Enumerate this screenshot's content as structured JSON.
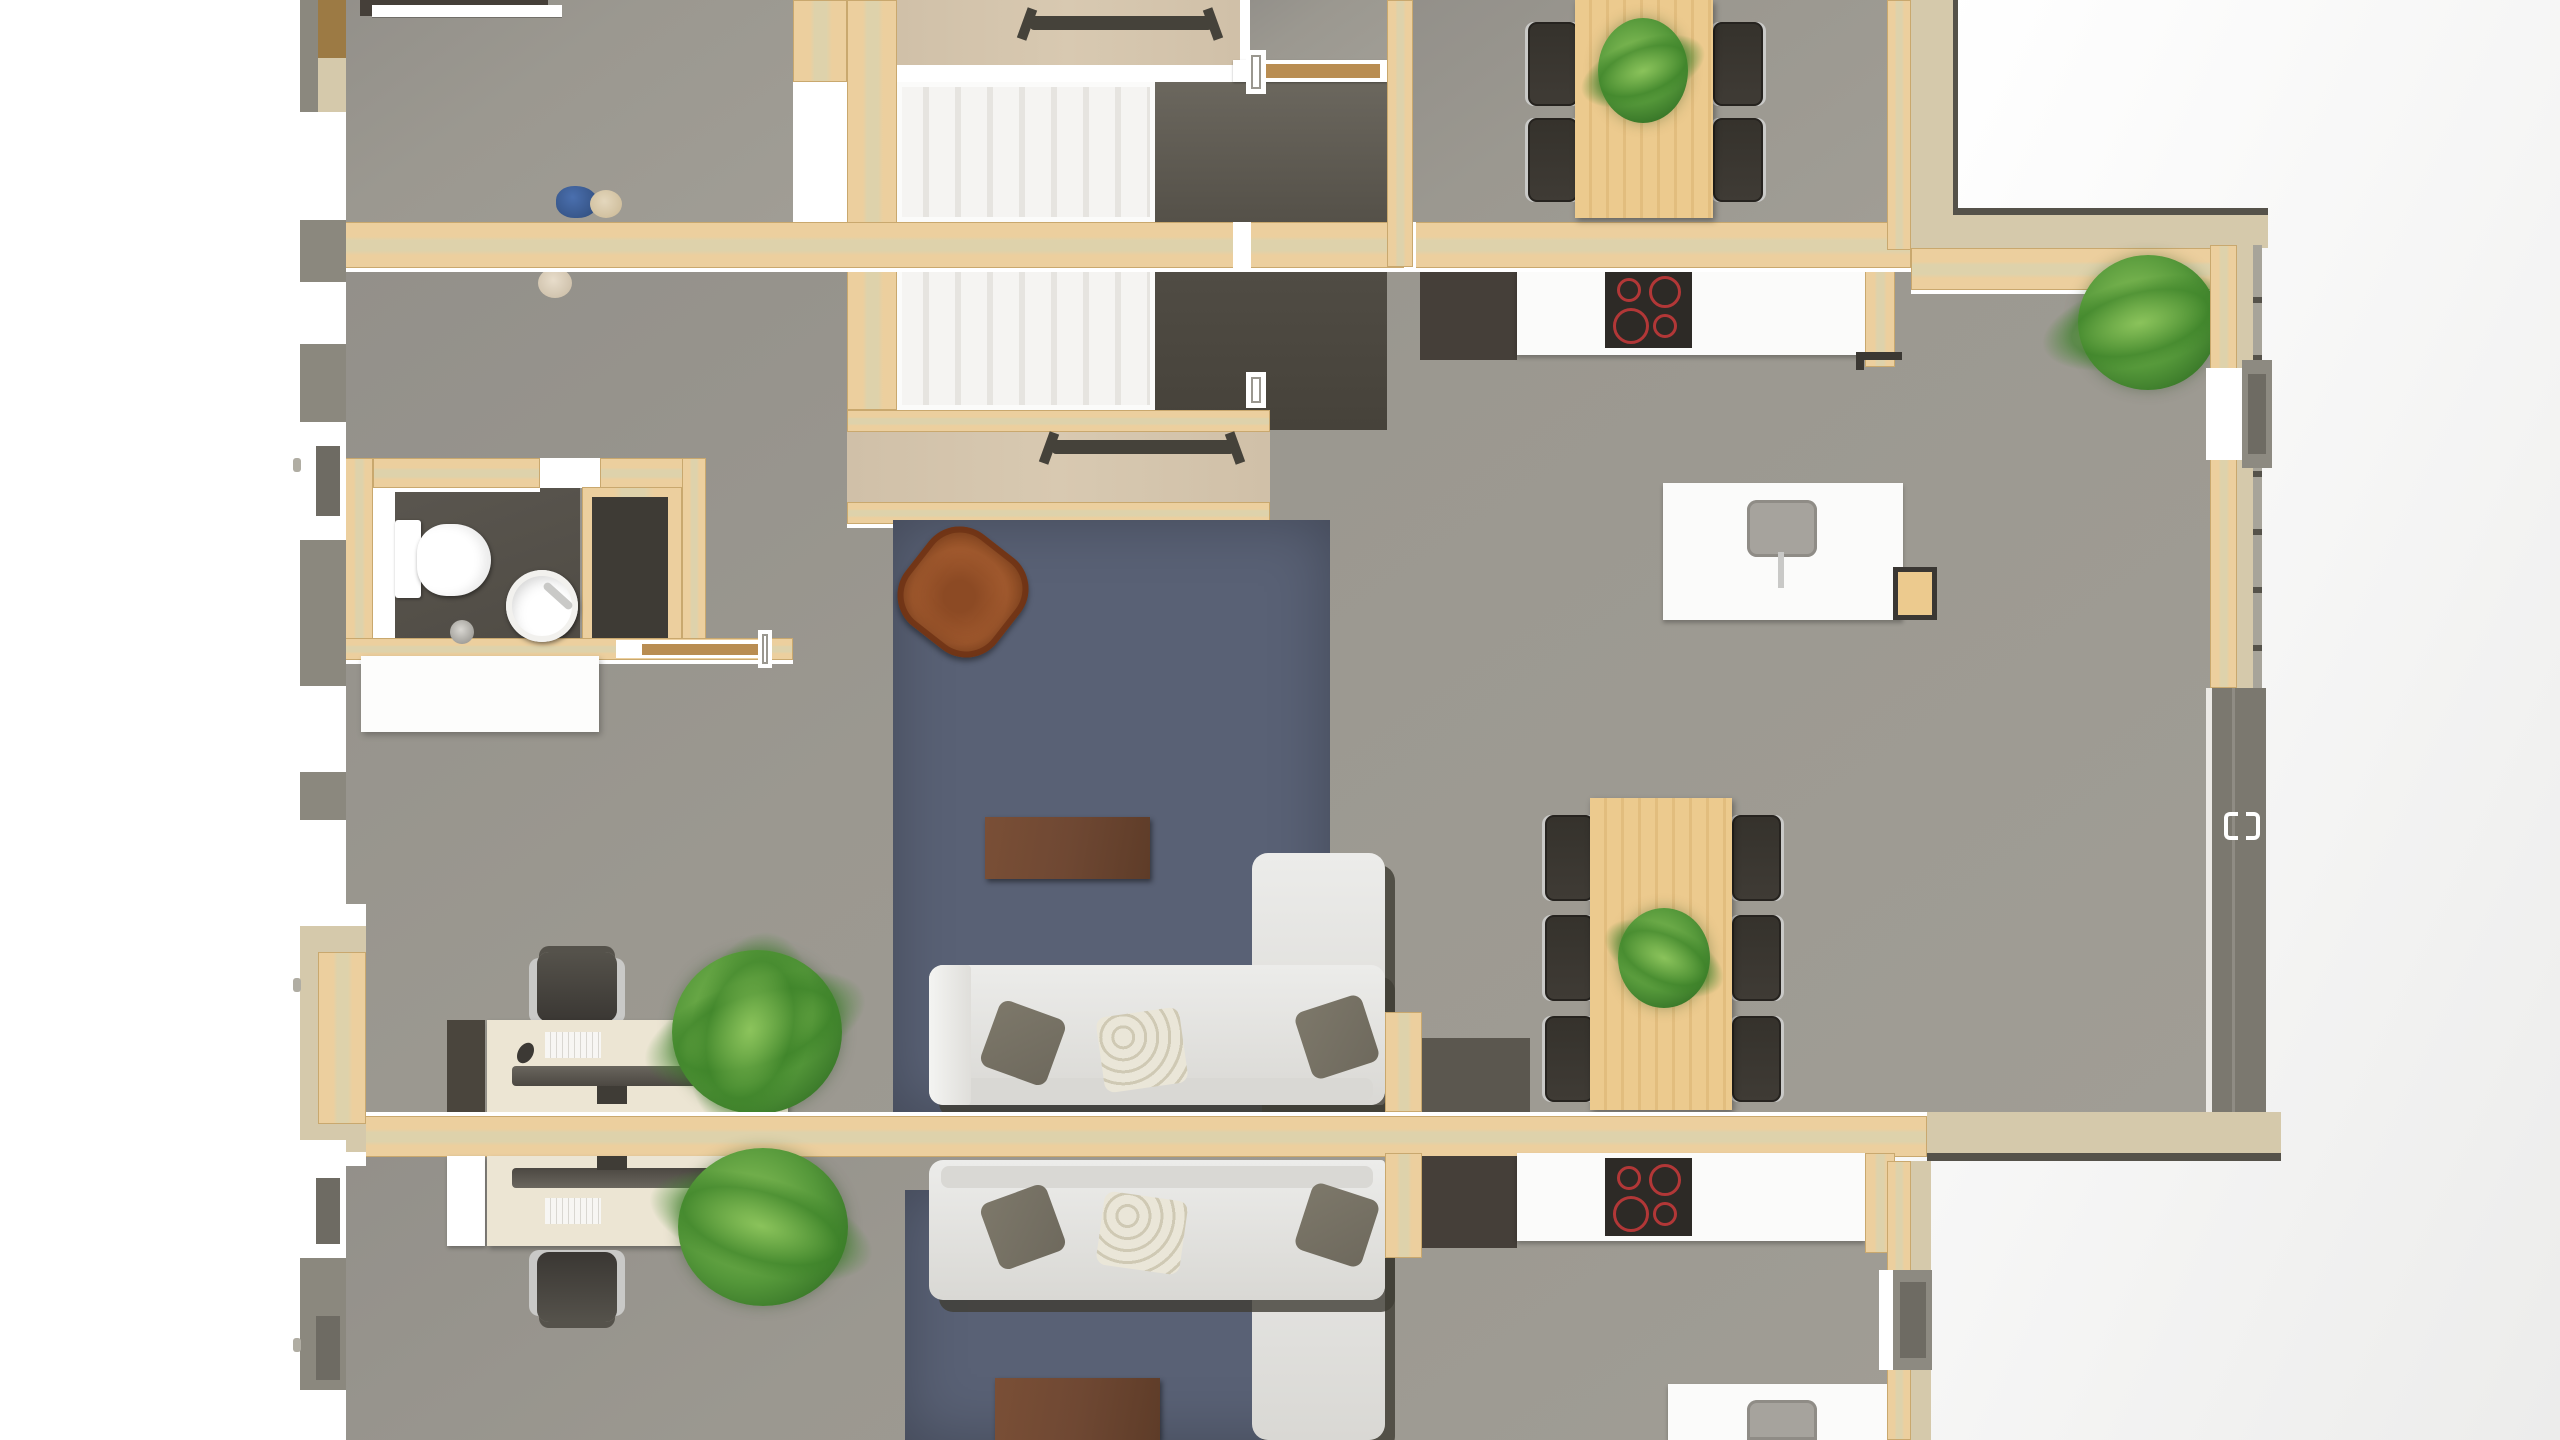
{
  "meta": {
    "kind": "3d-floorplan-top-down-render",
    "units": 2,
    "note": "photorealistic architectural plan render, no on-screen text"
  },
  "colors": {
    "floor": "#9b9890",
    "floor2": "#a09d95",
    "wood": "#eccf9e",
    "wood_stripe": "#ded2ab",
    "wood_edge": "#c9a86e",
    "landing": "#d0c0a8",
    "exterior_gray": "#8b887e",
    "exterior_beige": "#d5c9ab",
    "dark_floor": "#4f4b44",
    "closet_dark": "#3e3b35",
    "shaft_dark": "#524e46",
    "shaft_light": "#6b675e",
    "rug": "#596175",
    "table_brown": "#6f4833",
    "armchair": "#a35b2f",
    "armchair_dark": "#6e3315",
    "sofa": "#ececea",
    "sofa_shade": "#d9d8d4",
    "sofa_shadow": "#403d34",
    "pillow_dark": "#6e695d",
    "pillow_floral": "#eae6d8",
    "dining_wood": "#ecca8e",
    "chair_dark": "#3f3b35",
    "chair_edge": "#26231f",
    "metal": "#c9c9c7",
    "cooktop": "#2d2a26",
    "burner": "#b23737",
    "appliance_dark": "#453f39",
    "white": "#ffffff",
    "counter": "#fbfbfa",
    "sink": "#a6a39d",
    "sink_dark": "#8f8c86",
    "desk": "#ece5d3",
    "monitor": "#4c4842",
    "office_chair": "#3a3733",
    "plant_dark": "#2e6b22",
    "plant_mid": "#55983a",
    "plant_light": "#8cc45c",
    "bench": "#45423a",
    "step_a": "#f5f4f2",
    "step_b": "#e6e4e0",
    "glass_gray": "#7b786f",
    "window_box": "#8d8a81",
    "window_inner": "#6e6b63",
    "line_dark": "#55524a",
    "outside_shade": "#ececeb",
    "shoe_blue": "#4a6fae",
    "shoe_tan": "#c9b793",
    "bed_white": "#fdfdfc"
  },
  "scene": {
    "objects": [
      "stairwell-double-flight",
      "landing-bench-top",
      "landing-bench-bottom",
      "dining-table-top-with-plant",
      "dining-chairs-top-x4",
      "dining-table-mid-with-plant",
      "dining-chairs-mid-x6",
      "kitchen-counter-upper",
      "cooktop-4-burners-upper",
      "fridge-upper",
      "kitchen-island-with-sink-upper",
      "bar-stool",
      "kitchen-counter-lower",
      "cooktop-4-burners-lower",
      "fridge-lower",
      "kitchen-island-with-sink-lower",
      "blue-rug-upper",
      "coffee-table-upper",
      "l-shaped-sofa-upper",
      "pillows-x3-upper",
      "blue-rug-lower",
      "coffee-table-lower",
      "l-shaped-sofa-lower",
      "pillows-x3-lower",
      "leather-armchair",
      "bathroom-toilet",
      "bathroom-round-sink",
      "bathroom-shower-closet",
      "bathroom-cabinet",
      "white-wardrobe-bed",
      "desk-upper-with-monitor-keyboard-mouse",
      "office-chair-upper",
      "dark-cabinet-upper",
      "desk-lower-with-monitor-keyboard-phone",
      "office-chair-lower",
      "white-cabinet-lower",
      "palm-plant-upper-office",
      "palm-plant-lower-office",
      "palm-plant-balcony-corner",
      "shoes-pair",
      "slippers",
      "balcony-glass-sliding-door",
      "balcony-windows",
      "facade-windows-left",
      "sliding-door-top-bedroom",
      "sliding-door-hall",
      "sliding-door-shaft",
      "door-pivot-icons"
    ],
    "burner_rings_per_cooktop": 4,
    "stair_steps_per_flight": 8,
    "dining_chairs_top": 4,
    "dining_chairs_mid": 6
  }
}
